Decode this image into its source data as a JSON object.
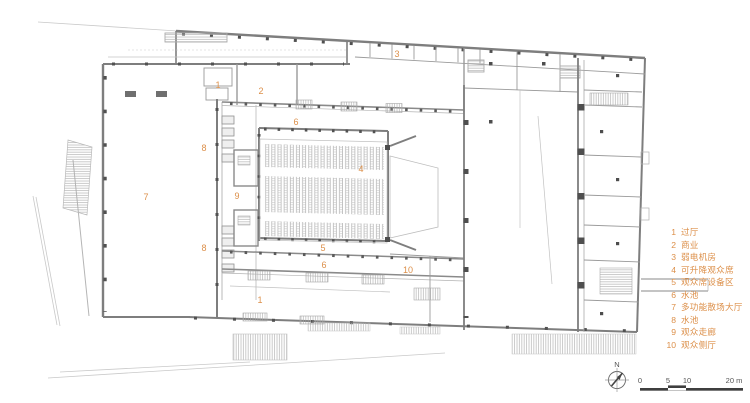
{
  "legend": {
    "items": [
      {
        "num": "1",
        "label": "过厅"
      },
      {
        "num": "2",
        "label": "商业"
      },
      {
        "num": "3",
        "label": "弱电机房"
      },
      {
        "num": "4",
        "label": "可升降观众席"
      },
      {
        "num": "5",
        "label": "观众席设备区"
      },
      {
        "num": "6",
        "label": "水池"
      },
      {
        "num": "7",
        "label": "多功能散场大厅"
      },
      {
        "num": "8",
        "label": "水池"
      },
      {
        "num": "9",
        "label": "观众走廊"
      },
      {
        "num": "10",
        "label": "观众侧厅"
      }
    ]
  },
  "plan_labels": {
    "l1": "1",
    "l2": "2",
    "l3": "3",
    "l4": "4",
    "l5": "5",
    "l6a": "6",
    "l6b": "6",
    "l7": "7",
    "l8a": "8",
    "l8b": "8",
    "l9": "9",
    "l10": "10",
    "l1b": "1"
  },
  "compass": {
    "north": "N"
  },
  "scale_bar": {
    "t0": "0",
    "t1": "5",
    "t2": "10",
    "t3": "20 m"
  },
  "colors": {
    "label_orange": "#DC8F49",
    "wall_gray": "#828282",
    "line_light": "#c3c3c3",
    "column_dark": "#4d4d4d"
  }
}
